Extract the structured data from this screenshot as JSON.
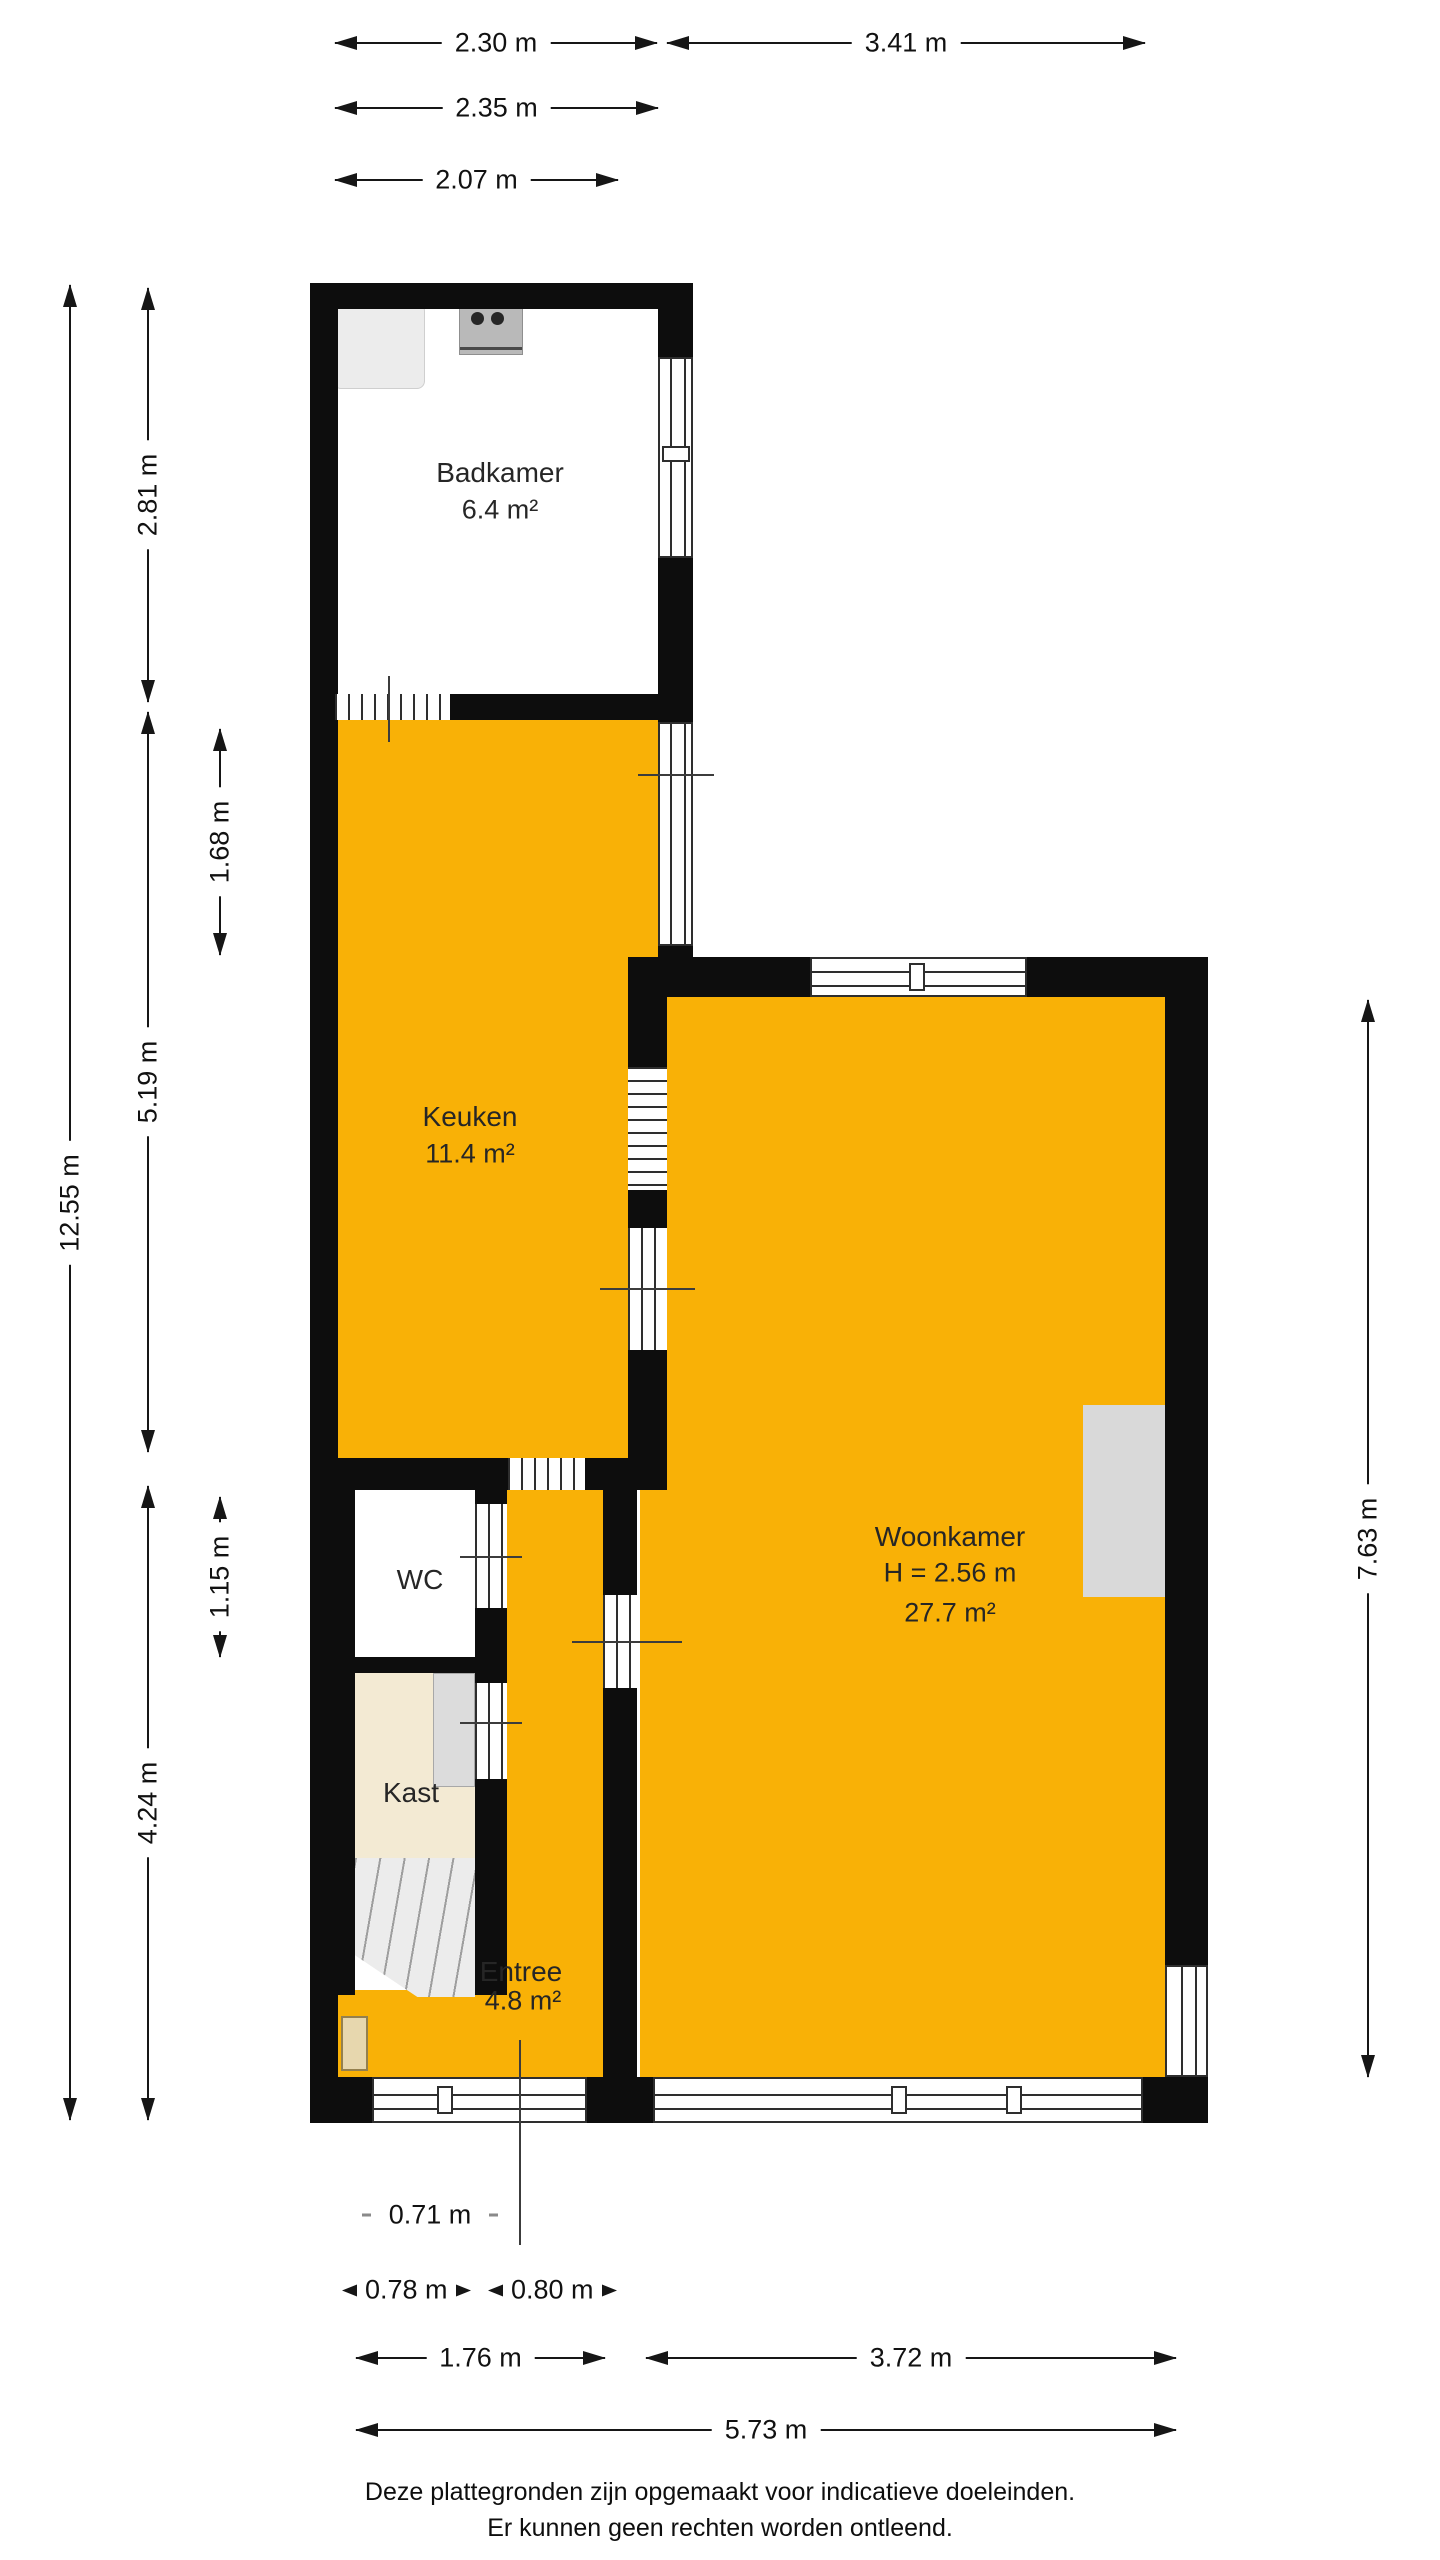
{
  "title_note": "floor plan",
  "colors": {
    "wall": "#0d0d0d",
    "floor_accent": "#f9b106",
    "kast_floor": "#f3ead3",
    "fixture_gray": "#dcdcdc",
    "door_tan": "#e7d7ae"
  },
  "rooms": {
    "badkamer": {
      "name": "Badkamer",
      "area": "6.4 m²"
    },
    "keuken": {
      "name": "Keuken",
      "area": "11.4 m²"
    },
    "woonkamer": {
      "name": "Woonkamer",
      "height_note": "H = 2.56 m",
      "area": "27.7 m²"
    },
    "wc": {
      "name": "WC"
    },
    "kast": {
      "name": "Kast"
    },
    "entree": {
      "name": "Entree",
      "area": "4.8 m²"
    }
  },
  "fixtures": {
    "shower": "shower-tray-icon",
    "stove": "stove-icon",
    "closet": "closet-icon",
    "fireplace": "wall-unit-icon",
    "front_door": "front-door-icon",
    "stairs": "stairs-icon"
  },
  "dimensions": {
    "top": [
      "2.30 m",
      "3.41 m",
      "2.35 m",
      "2.07 m"
    ],
    "left": [
      "12.55 m",
      "2.81 m",
      "5.19 m",
      "4.24 m",
      "1.68 m",
      "1.15 m"
    ],
    "right": [
      "7.63 m"
    ],
    "bottom": [
      "0.71 m",
      "0.78 m",
      "0.80 m",
      "1.76 m",
      "3.72 m",
      "5.73 m"
    ]
  },
  "footer": {
    "line1": "Deze plattegronden zijn opgemaakt voor indicatieve doeleinden.",
    "line2": "Er kunnen geen rechten worden ontleend."
  }
}
